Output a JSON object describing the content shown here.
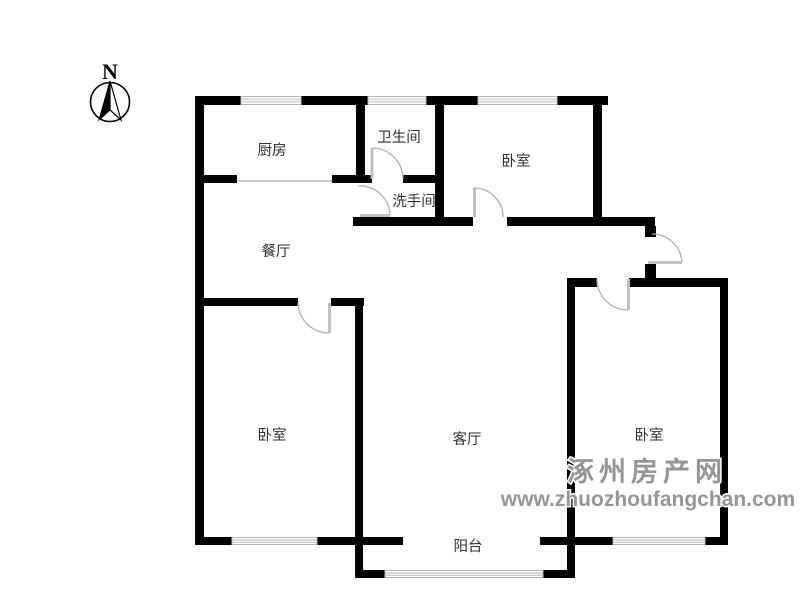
{
  "compass": {
    "label": "N"
  },
  "rooms": {
    "kitchen": "厨房",
    "bathroom": "卫生间",
    "washroom": "洗手间",
    "bedroom_north": "卧室",
    "dining": "餐厅",
    "bedroom_west": "卧室",
    "living": "客厅",
    "bedroom_east": "卧室",
    "balcony": "阳台"
  },
  "watermark": {
    "site_name": "涿州房产网",
    "url": "www.zhuozhoufangchan.com"
  },
  "colors": {
    "wall": "#000000",
    "window_line": "#c4c4c4",
    "door": "#b0b0b0",
    "label_text": "#2f2f2f",
    "watermark_gray": "#969696"
  }
}
